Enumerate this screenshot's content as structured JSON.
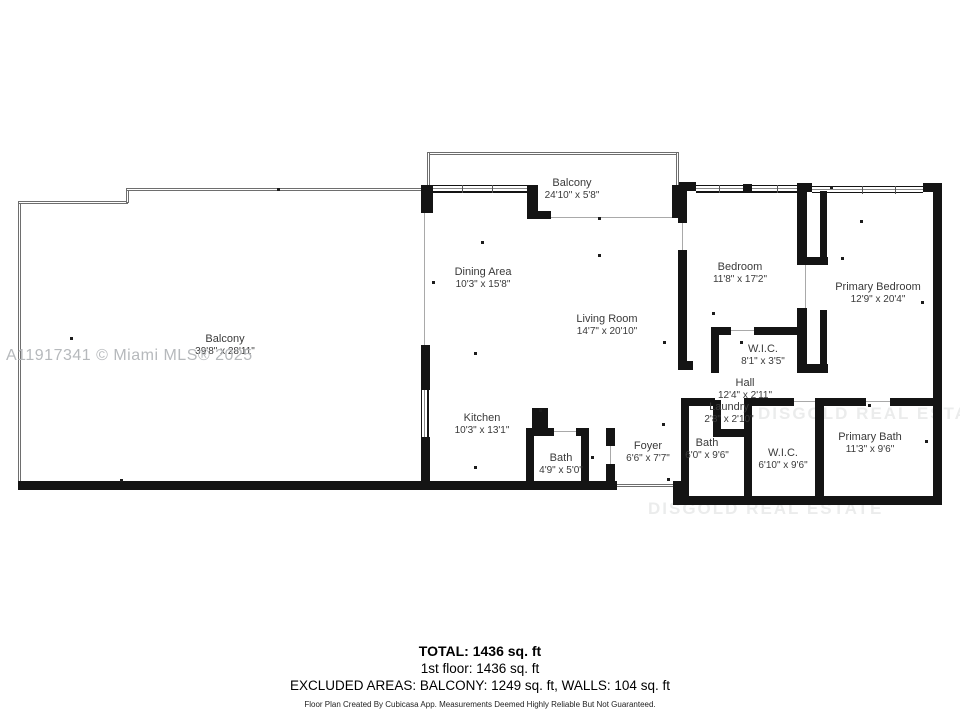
{
  "plan": {
    "mls_watermark": "A11917341 © Miami MLS® 2025",
    "brand_watermark": "DISGOLD REAL ESTATE",
    "rooms": [
      {
        "name": "Balcony",
        "dims": "24'10\" x 5'8\""
      },
      {
        "name": "Balcony",
        "dims": "39'8\" x 28'11\""
      },
      {
        "name": "Dining Area",
        "dims": "10'3\" x 15'8\""
      },
      {
        "name": "Living Room",
        "dims": "14'7\" x 20'10\""
      },
      {
        "name": "Kitchen",
        "dims": "10'3\" x 13'1\""
      },
      {
        "name": "Bath",
        "dims": "4'9\" x 5'0\""
      },
      {
        "name": "Foyer",
        "dims": "6'6\" x 7'7\""
      },
      {
        "name": "Bedroom",
        "dims": "11'8\" x 17'2\""
      },
      {
        "name": "W.I.C.",
        "dims": "8'1\" x 3'5\""
      },
      {
        "name": "Primary Bedroom",
        "dims": "12'9\" x 20'4\""
      },
      {
        "name": "Hall",
        "dims": "12'4\" x 2'11\""
      },
      {
        "name": "Laundry",
        "dims": "2'8\" x 2'10\""
      },
      {
        "name": "Bath",
        "dims": "6'0\" x 9'6\""
      },
      {
        "name": "W.I.C.",
        "dims": "6'10\" x 9'6\""
      },
      {
        "name": "Primary Bath",
        "dims": "11'3\" x 9'6\""
      }
    ],
    "summary": {
      "total": "TOTAL: 1436 sq. ft",
      "floor": "1st floor: 1436 sq. ft",
      "excluded": "EXCLUDED AREAS: BALCONY: 1249 sq. ft, WALLS: 104 sq. ft",
      "disclaimer": "Floor Plan Created By Cubicasa App. Measurements Deemed Highly Reliable But Not Guaranteed."
    },
    "colors": {
      "wall": "#141414",
      "label": "#3a3a3a",
      "mls_watermark": "#b6b9bc"
    }
  }
}
